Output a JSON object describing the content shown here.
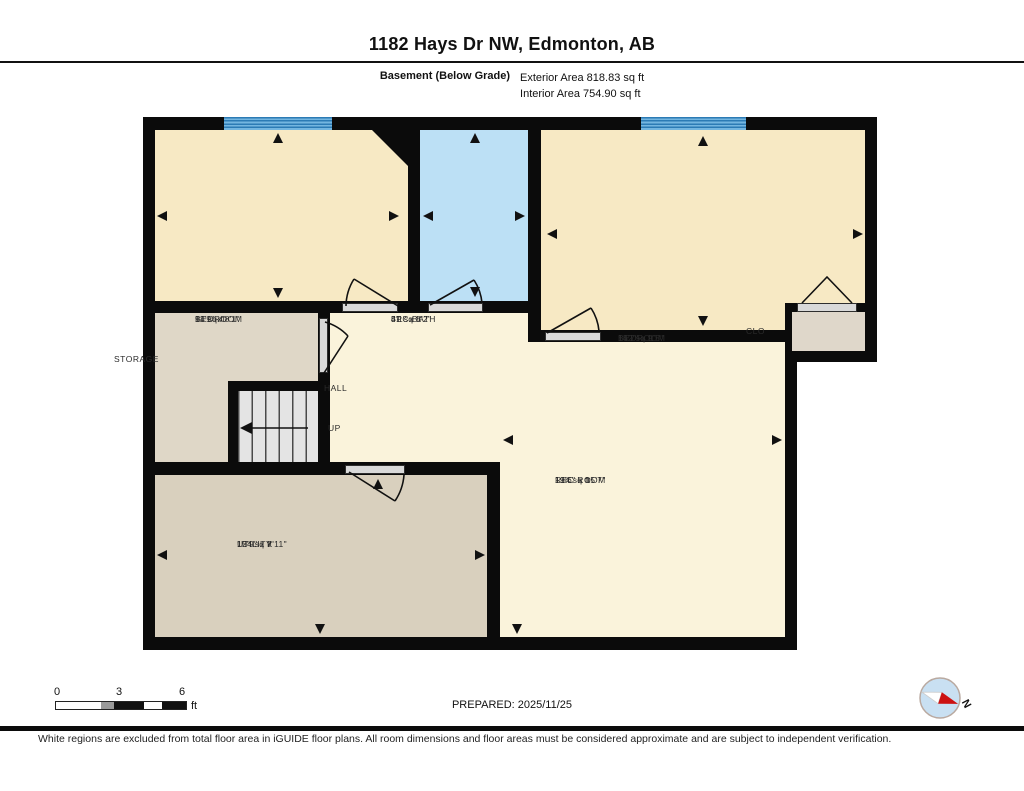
{
  "header": {
    "title": "1182 Hays Dr NW, Edmonton, AB",
    "floor_label": "Basement (Below Grade)",
    "exterior_area": "Exterior Area 818.83 sq ft",
    "interior_area": "Interior Area 754.90 sq ft"
  },
  "rooms": [
    {
      "name": "BEDROOM",
      "dims": "11'9\" x 8'1\"",
      "area": "94 sq ft"
    },
    {
      "name": "3PC BATH",
      "dims": "5'1\" x 8'2\"",
      "area": "41 sq ft"
    },
    {
      "name": "BEDROOM",
      "dims": "15'7\" x 9'5\"",
      "area": "142 sq ft"
    },
    {
      "name": "CLO"
    },
    {
      "name": "STORAGE"
    },
    {
      "name": "HALL"
    },
    {
      "name": "UP"
    },
    {
      "name": "REC ROOM",
      "dims": "13'6\" x 15'7\"",
      "area": "194 sq ft"
    },
    {
      "name": "UTILITY",
      "dims": "15'9\" x 7'11\"",
      "area": "124 sq ft"
    }
  ],
  "scale_bar": {
    "tick_0": "0",
    "tick_3": "3",
    "tick_6": "6",
    "unit": "ft"
  },
  "prepared": "PREPARED: 2025/11/25",
  "compass": {
    "north_label": "N"
  },
  "disclaimer": "White regions are excluded from total floor area in iGUIDE floor plans. All room dimensions and floor areas must be considered approximate and are subject to independent verification.",
  "colors": {
    "wall": "#0b0b0b",
    "bedroom_fill": "#F7E9C4",
    "bath_fill": "#BCE0F5",
    "hall_rec_fill": "#FAF3DB",
    "storage_fill": "#DFD7C7",
    "utility_fill": "#D9D0BE",
    "closet_fill": "#DFD7CA",
    "window_blue": "#74B6E0",
    "compass_needle_red": "#CC1111"
  }
}
